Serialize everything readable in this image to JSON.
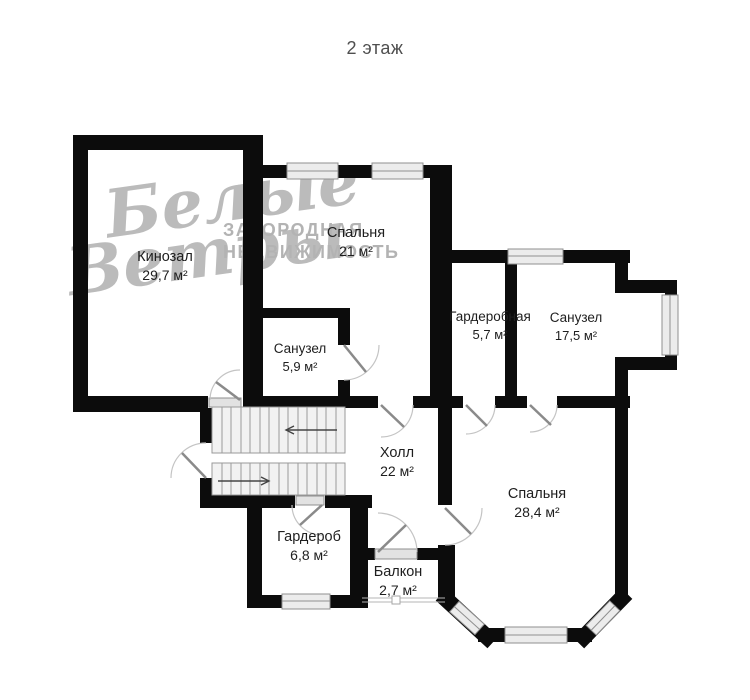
{
  "title": "2 этаж",
  "watermark": {
    "script1": "Белые",
    "script2": "Ветры",
    "caps1": "ЗАГОРОДНАЯ",
    "caps2": "НЕДВИЖИМОСТЬ"
  },
  "rooms": [
    {
      "name": "Кинозал",
      "area": "29,7 м²"
    },
    {
      "name": "Спальня",
      "area": "21 м²"
    },
    {
      "name": "Санузел",
      "area": "5,9 м²"
    },
    {
      "name": "Гардеробная",
      "area": "5,7 м²"
    },
    {
      "name": "Санузел",
      "area": "17,5 м²"
    },
    {
      "name": "Холл",
      "area": "22 м²"
    },
    {
      "name": "Спальня",
      "area": "28,4 м²"
    },
    {
      "name": "Гардероб",
      "area": "6,8 м²"
    },
    {
      "name": "Балкон",
      "area": "2,7 м²"
    }
  ],
  "colors": {
    "wall": "#0c0c0c",
    "window_fill": "#ececec",
    "window_stroke": "#8f8f8f",
    "stair_fill": "#f2f2f2",
    "stair_stroke": "#999999",
    "door_leaf": "#8a8a8a",
    "door_arc": "#c4c4c4",
    "label_text": "#1e1e1e",
    "watermark": "#b0b0b0",
    "title_text": "#4f4f4f"
  }
}
